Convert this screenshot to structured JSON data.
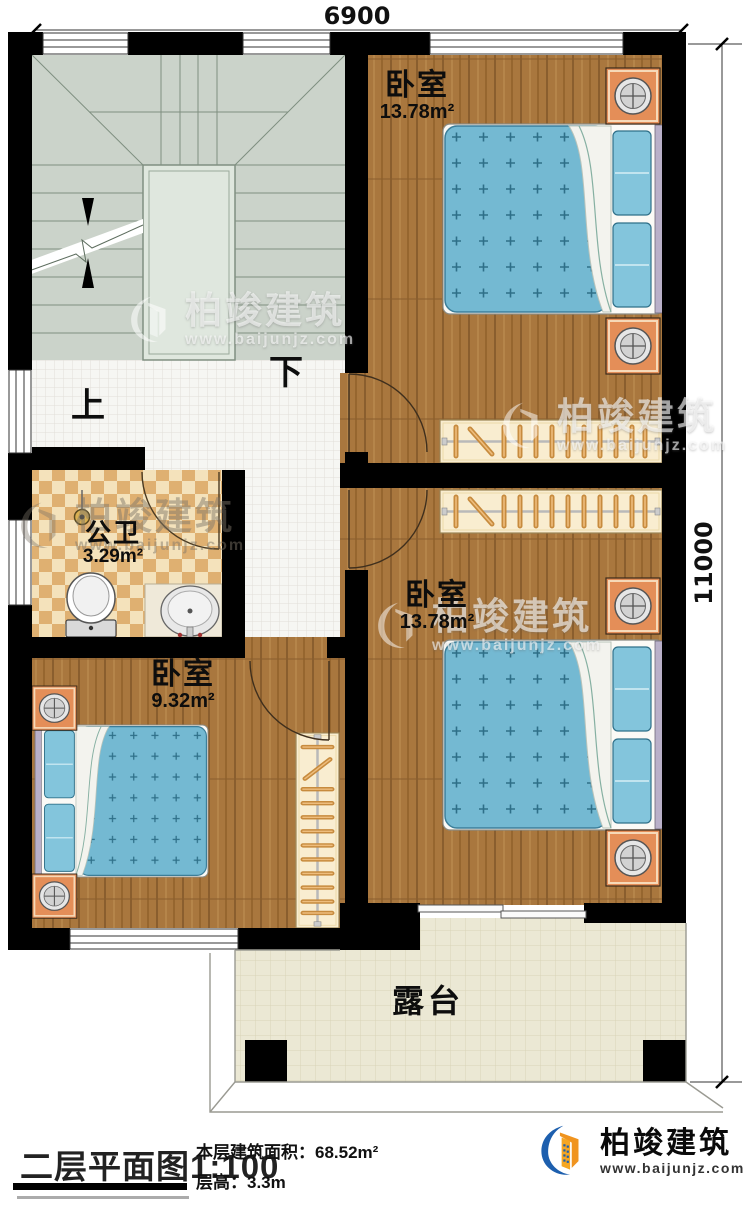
{
  "dimensions": {
    "top": "6900",
    "right": "11000"
  },
  "stairs": {
    "up": "上",
    "down": "下"
  },
  "rooms": {
    "bedroom_top_right": {
      "name": "卧室",
      "area": "13.78m²"
    },
    "bedroom_mid_right": {
      "name": "卧室",
      "area": "13.78m²"
    },
    "bedroom_bottom_left": {
      "name": "卧室",
      "area": "9.32m²"
    },
    "bathroom": {
      "name": "公卫",
      "area": "3.29m²"
    },
    "terrace": {
      "name": "露台"
    }
  },
  "legend": {
    "title": "二层平面图",
    "scale": "1:100",
    "floor_area_label": "本层建筑面积：",
    "floor_area_value": "68.52m²",
    "floor_height_label": "层高：",
    "floor_height_value": "3.3m"
  },
  "brand": {
    "name": "柏竣建筑",
    "url": "www.baijunjz.com"
  },
  "colors": {
    "wall": "#000000",
    "wood_floor": "#a9773e",
    "stair_floor": "#cbd3ca",
    "corridor_tile": "#f6f6f3",
    "bath_checker": "#dfb071",
    "terrace_tile": "#ebe8d4",
    "mattress_blue": "#74b9d2",
    "nightstand_orange": "#e48e58",
    "closet_cream": "#f9edd0",
    "logo_blue": "#1d5fae",
    "logo_orange": "#f0941f"
  }
}
